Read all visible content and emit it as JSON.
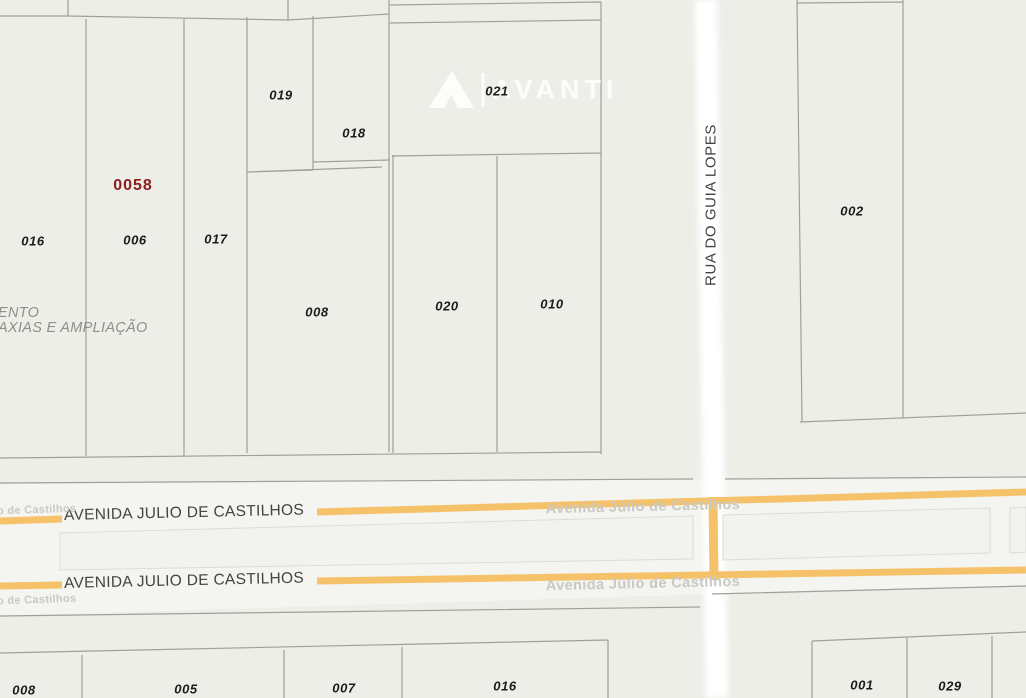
{
  "colors": {
    "background": "#eeeee9",
    "road_corridor": "#f4f4f1",
    "road_white": "#ffffff",
    "avenue_orange": "#f6c269",
    "parcel_line": "#a0a099",
    "median_line": "#dcdcd7",
    "lot_label": "#1b1b1b",
    "lot_label_red": "#8b1d1d",
    "street_label": "#434343",
    "street_label_faint": "#c9c9c3",
    "annotation_gray": "#8f8f89"
  },
  "lots": [
    {
      "text": "019",
      "x": 281,
      "y": 95
    },
    {
      "text": "018",
      "x": 354,
      "y": 133
    },
    {
      "text": "021",
      "x": 497,
      "y": 91
    },
    {
      "text": "0058",
      "x": 133,
      "y": 186,
      "red": true
    },
    {
      "text": "016",
      "x": 33,
      "y": 241
    },
    {
      "text": "006",
      "x": 135,
      "y": 240
    },
    {
      "text": "017",
      "x": 216,
      "y": 239
    },
    {
      "text": "008",
      "x": 317,
      "y": 312
    },
    {
      "text": "020",
      "x": 447,
      "y": 306
    },
    {
      "text": "010",
      "x": 552,
      "y": 304
    },
    {
      "text": "002",
      "x": 852,
      "y": 211
    },
    {
      "text": "008",
      "x": 24,
      "y": 690
    },
    {
      "text": "005",
      "x": 186,
      "y": 689
    },
    {
      "text": "007",
      "x": 344,
      "y": 688
    },
    {
      "text": "016",
      "x": 505,
      "y": 686
    },
    {
      "text": "001",
      "x": 862,
      "y": 685
    },
    {
      "text": "029",
      "x": 950,
      "y": 686
    }
  ],
  "streets": {
    "rua_vertical": "RUA DO GUIA LOPES",
    "avenida_main": "AVENIDA JULIO DE CASTILHOS",
    "avenida_faint_full": "Avenida Júlio de Castilhos",
    "avenida_faint_partial": "o de Castilhos"
  },
  "annotations": {
    "line1": "ENTO",
    "line2": "AXIAS E AMPLIAÇÃO"
  },
  "watermark": {
    "brand": "AVANTI"
  }
}
